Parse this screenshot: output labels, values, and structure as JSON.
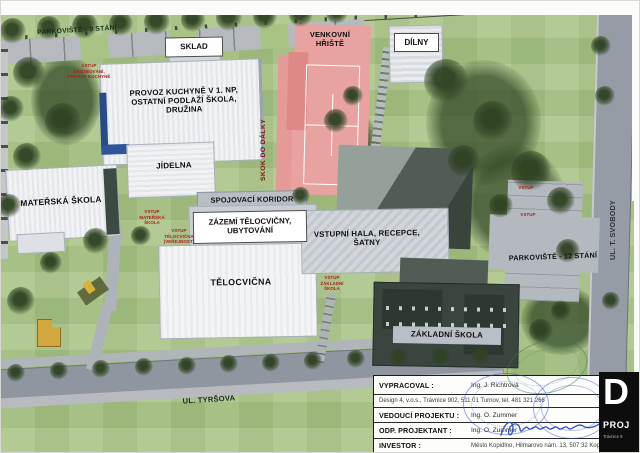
{
  "labels": {
    "parking9": "PARKOVIŠTĚ - 9 STÁNÍ",
    "sklad": "SKLAD",
    "venkovni": "VENKOVNÍ\nHŘIŠTĚ",
    "dilny": "DÍLNY",
    "provoz": "PROVOZ KUCHYNĚ V 1. NP,\nOSTATNÍ PODLAŽÍ ŠKOLA,\nDRUŽINA",
    "jidelna": "JÍDELNA",
    "materska": "MATEŘSKÁ ŠKOLA",
    "koridor": "SPOJOVACÍ KORIDOR",
    "zazemi": "ZÁZEMÍ TĚLOCVIČNY,\nUBYTOVÁNÍ",
    "vstupni": "VSTUPNÍ HALA, RECEPCE,\nŠATNY",
    "telocvicna": "TĚLOCVIČNA",
    "zakladni": "ZÁKLADNÍ ŠKOLA",
    "parking12": "PARKOVIŠTĚ - 12 STÁNÍ"
  },
  "streets": {
    "tyrsova": "UL. TYRŠOVA",
    "svobody": "UL. T. SVOBODY"
  },
  "red_annotations": {
    "skok": "SKOK DO DÁLKY",
    "vstup_kuchyne": "VSTUP\nZÁSOBOVÁNÍ,\nPROVOZ KUCHYNĚ",
    "vstup_materska": "VSTUP\nMATEŘSKÁ\nŠKOLA",
    "vstup_telocvicna": "VSTUP\nTĚLOCVIČNA\n(VEŘEJNOST)",
    "vstup_zakladni": "VSTUP\nZÁKLADNÍ\nŠKOLA",
    "vstup_parking_1": "VSTUP",
    "vstup_parking_2": "VSTUP"
  },
  "title_block": {
    "rows": [
      {
        "label": "VYPRACOVAL :",
        "value": "Ing. J. Richtrová"
      },
      {
        "label": "",
        "value": "Design 4, v.o.s., Trávnice 902, 511 01 Turnov, tel. 481 321 266"
      },
      {
        "label": "VEDOUCÍ PROJEKTU :",
        "value": "Ing. O. Zummer"
      },
      {
        "label": "ODP. PROJEKTANT :",
        "value": "Ing. O. Zummer"
      },
      {
        "label": "INVESTOR :",
        "value": "Město Kopidlno, Hilmarovo nám. 13, 507 32 Kopidlno"
      }
    ],
    "logo": {
      "letter": "D",
      "line1": "PROJ",
      "line2": "Trávnice 9"
    }
  },
  "colors": {
    "grass": "#a9c385",
    "court_pink": "#e8a3a1",
    "road_gray": "#9099a2",
    "dark_building": "#39453e",
    "annotation_red": "#a8201a",
    "stamp_blue": "#2b4ec9",
    "stamp_green": "#3c8a52"
  }
}
